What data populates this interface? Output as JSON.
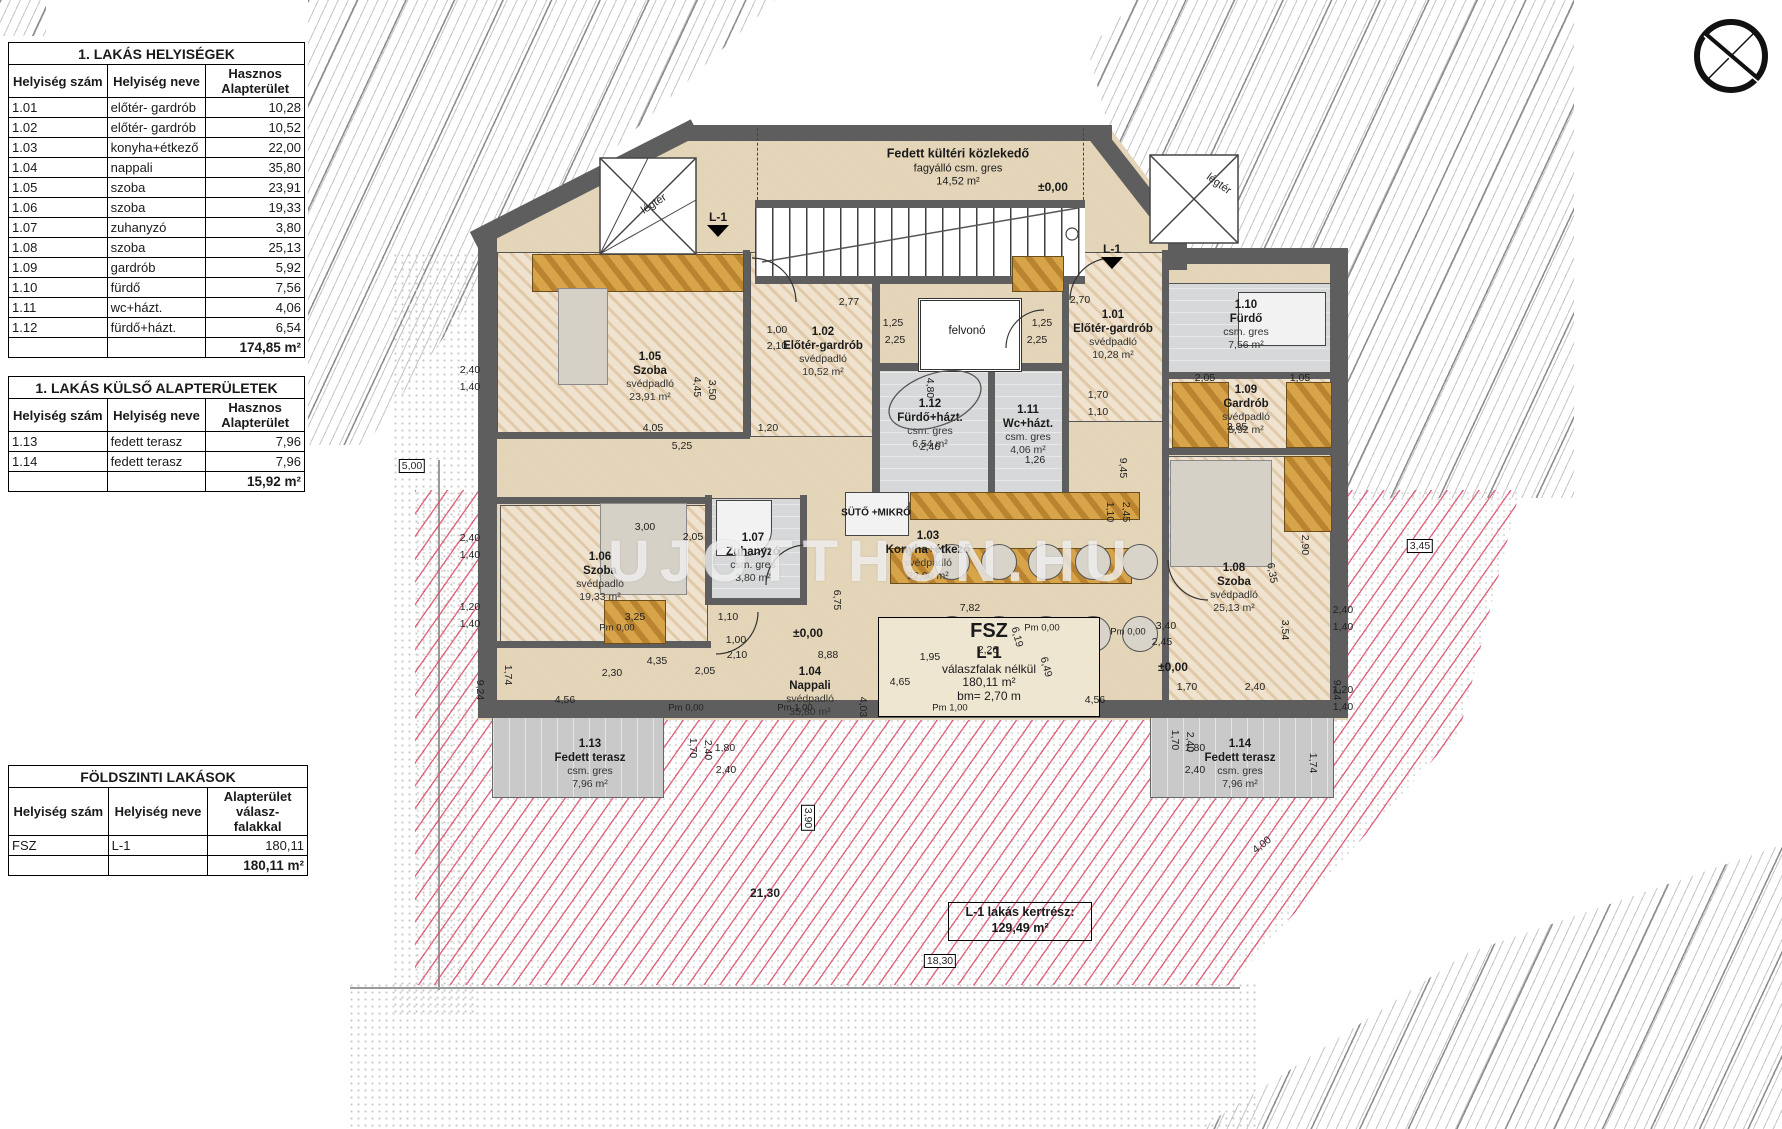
{
  "tables": [
    {
      "title": "1. LAKÁS HELYISÉGEK",
      "headers": [
        "Helyiség szám",
        "Helyiség neve",
        "Hasznos Alapterület"
      ],
      "rows": [
        [
          "1.01",
          "előtér- gardrób",
          "10,28"
        ],
        [
          "1.02",
          "előtér- gardrób",
          "10,52"
        ],
        [
          "1.03",
          "konyha+étkező",
          "22,00"
        ],
        [
          "1.04",
          "nappali",
          "35,80"
        ],
        [
          "1.05",
          "szoba",
          "23,91"
        ],
        [
          "1.06",
          "szoba",
          "19,33"
        ],
        [
          "1.07",
          "zuhanyzó",
          "3,80"
        ],
        [
          "1.08",
          "szoba",
          "25,13"
        ],
        [
          "1.09",
          "gardrób",
          "5,92"
        ],
        [
          "1.10",
          "fürdő",
          "7,56"
        ],
        [
          "1.11",
          "wc+házt.",
          "4,06"
        ],
        [
          "1.12",
          "fürdő+házt.",
          "6,54"
        ]
      ],
      "total": "174,85 m²"
    },
    {
      "title": "1. LAKÁS KÜLSŐ ALAPTERÜLETEK",
      "headers": [
        "Helyiség szám",
        "Helyiség neve",
        "Hasznos Alapterület"
      ],
      "rows": [
        [
          "1.13",
          "fedett terasz",
          "7,96"
        ],
        [
          "1.14",
          "fedett terasz",
          "7,96"
        ]
      ],
      "total": "15,92 m²"
    },
    {
      "title": "FÖLDSZINTI LAKÁSOK",
      "headers": [
        "Helyiség szám",
        "Helyiség neve",
        "Alapterület válasz- falakkal"
      ],
      "rows": [
        [
          "FSZ",
          "L-1",
          "180,11"
        ]
      ],
      "total": "180,11 m²"
    }
  ],
  "plan": {
    "corridor": {
      "l1": "Fedett kültéri közlekedő",
      "l2": "fagyálló csm. gres",
      "l3": "14,52 m²"
    },
    "elevator": "felvonó",
    "oven": "SÜTŐ +MIKRÓ",
    "legter": "légtér",
    "level_mark": "±0,00",
    "section_mark": "L-1",
    "watermark": "UJOTTHON.HU",
    "rooms": [
      {
        "no": "1.05",
        "name": "Szoba",
        "floor": "svédpadló",
        "area": "23,91 m²"
      },
      {
        "no": "1.02",
        "name": "Előtér-gardrób",
        "floor": "svédpadló",
        "area": "10,52 m²"
      },
      {
        "no": "1.12",
        "name": "Fürdő+házt.",
        "floor": "csm. gres",
        "area": "6,54 m²"
      },
      {
        "no": "1.11",
        "name": "Wc+házt.",
        "floor": "csm. gres",
        "area": "4,06 m²"
      },
      {
        "no": "1.01",
        "name": "Előtér-gardrób",
        "floor": "svédpadló",
        "area": "10,28 m²"
      },
      {
        "no": "1.10",
        "name": "Fürdő",
        "floor": "csm. gres",
        "area": "7,56 m²"
      },
      {
        "no": "1.09",
        "name": "Gardrób",
        "floor": "svédpadló",
        "area": "5,92 m²"
      },
      {
        "no": "1.06",
        "name": "Szoba",
        "floor": "svédpadló",
        "area": "19,33 m²"
      },
      {
        "no": "1.07",
        "name": "Zuhanyzó",
        "floor": "csm. gres",
        "area": "3,80 m²"
      },
      {
        "no": "1.03",
        "name": "Konyha+étkező",
        "floor": "svédpadló",
        "area": "22,00 m²"
      },
      {
        "no": "1.04",
        "name": "Nappali",
        "floor": "svédpadló",
        "area": "35,80 m²"
      },
      {
        "no": "1.08",
        "name": "Szoba",
        "floor": "svédpadló",
        "area": "25,13 m²"
      },
      {
        "no": "1.13",
        "name": "Fedett terasz",
        "floor": "csm. gres",
        "area": "7,96 m²"
      },
      {
        "no": "1.14",
        "name": "Fedett terasz",
        "floor": "csm. gres",
        "area": "7,96 m²"
      }
    ],
    "fsz_box": {
      "l1": "FSZ",
      "l2": "L-1",
      "l3": "válaszfalak nélkül",
      "l4": "180,11 m²",
      "l5": "bm= 2,70 m"
    },
    "garden_box": {
      "l1": "L-1 lakás kertrész:",
      "l2": "129,49 m²"
    },
    "pm_marks": [
      "Pm 0,00",
      "Pm 0,00",
      "Pm 1,00",
      "Pm 1,00",
      "Pm 0,00",
      "Pm 0,00"
    ],
    "dims": [
      "2,77",
      "2,70",
      "1,25",
      "1,25",
      "2,25",
      "2,25",
      "1,00",
      "2,10",
      "4,05",
      "5,25",
      "1,20",
      "3,00",
      "2,05",
      "3,25",
      "1,10",
      "4,35",
      "2,30",
      "2,05",
      "1,00",
      "2,10",
      "7,82",
      "8,88",
      "1,95",
      "2,26",
      "4,65",
      "1,10",
      "2,45",
      "6,75",
      "6,19",
      "6,49",
      "4,03",
      "3,40",
      "2,45",
      "1,70",
      "2,40",
      "2,05",
      "1,05",
      "3,85",
      "2,40",
      "1,40",
      "2,40",
      "1,40",
      "1,20",
      "1,40",
      "2,40",
      "1,40",
      "1,20",
      "1,40",
      "21,30",
      "18,30",
      "4,00",
      "3,45",
      "5,00",
      "9,24",
      "9,24",
      "3,90",
      "4,56",
      "4,56",
      "1,74",
      "1,74",
      "1,80",
      "2,40",
      "1,70",
      "2,40",
      "1,80",
      "2,40",
      "1,70",
      "2,40",
      "4,80",
      "4,45",
      "3,50",
      "2,46",
      "1,26",
      "9,45",
      "2,90",
      "6,35",
      "3,54",
      "1,70",
      "1,10"
    ]
  }
}
